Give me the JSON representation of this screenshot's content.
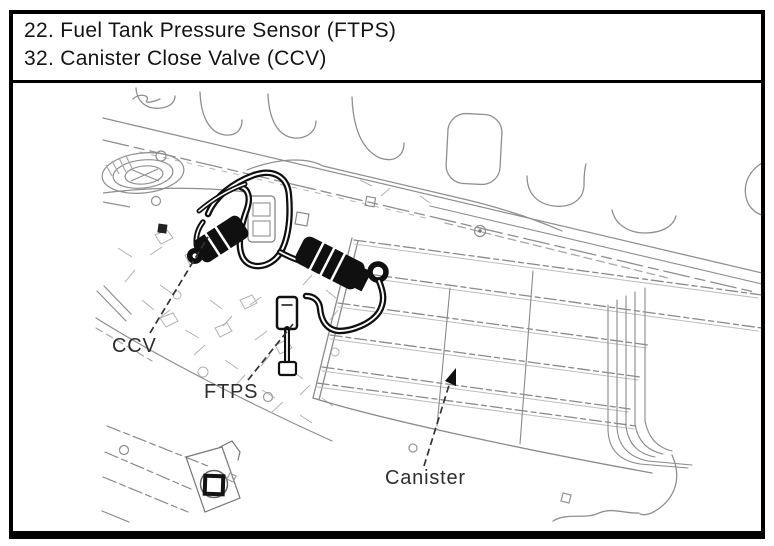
{
  "figure": {
    "legend_lines": [
      "22. Fuel Tank Pressure Sensor (FTPS)",
      "32. Canister Close Valve (CCV)"
    ],
    "callouts": {
      "ccv": "CCV",
      "ftps": "FTPS",
      "canister": "Canister"
    },
    "colors": {
      "border": "#000000",
      "drawing_line": "#8f8f8f",
      "bold_component": "#101010",
      "text": "#141414"
    }
  }
}
